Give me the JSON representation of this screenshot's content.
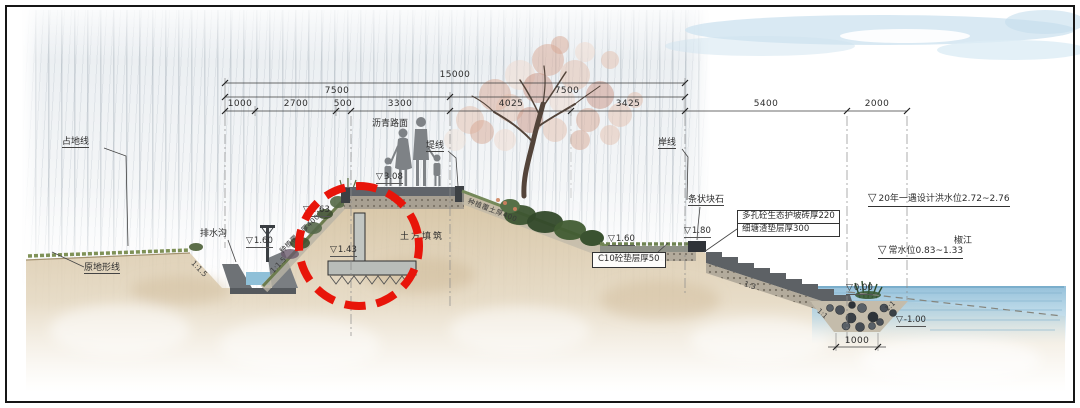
{
  "drawing": {
    "symbols": {
      "elevation": "▽"
    },
    "dimensions": {
      "total": "15000",
      "upper_left": "7500",
      "upper_right": "7500",
      "segments": [
        "1000",
        "2700",
        "500",
        "3300",
        "4025",
        "3425",
        "5400",
        "2000"
      ],
      "trench_width": "1000"
    },
    "labels": {
      "land_take_line": "占地线",
      "original_terrain_line": "原地形线",
      "drainage_ditch": "排水沟",
      "asphalt_pavement": "沥青路面",
      "dike_line": "堤线",
      "shore_line": "岸线",
      "river_name": "椒江"
    },
    "materials": {
      "earth_fill": "土方填筑",
      "planting_soil": "种植覆土厚400",
      "strip_stone": "条状块石",
      "porous_brick": "多孔砼生态护坡砖厚220",
      "slag_cushion": "细塘渣垫层厚300",
      "c10_cushion": "C10砼垫层厚50"
    },
    "elevations": {
      "wall_top": "2.63",
      "road": "3.08",
      "ditch": "1.60",
      "wall_footing": "1.43",
      "terrace": "1.60",
      "stair_top": "1.80",
      "stair_toe": "0.00",
      "trench_bottom": "-1.00"
    },
    "water_levels": {
      "flood": "20年一遇设计洪水位2.72~2.76",
      "normal": "常水位0.83~1.33"
    },
    "slopes": {
      "ditch_left": "1:1.5",
      "ditch_right": "1:1.5",
      "stairs": "1:3",
      "trench_left": "1:1",
      "trench_right": "1:1"
    },
    "colors": {
      "highlight": "#e8150a",
      "water": "#a9cfe2",
      "soil": "#d8c5a5"
    }
  }
}
